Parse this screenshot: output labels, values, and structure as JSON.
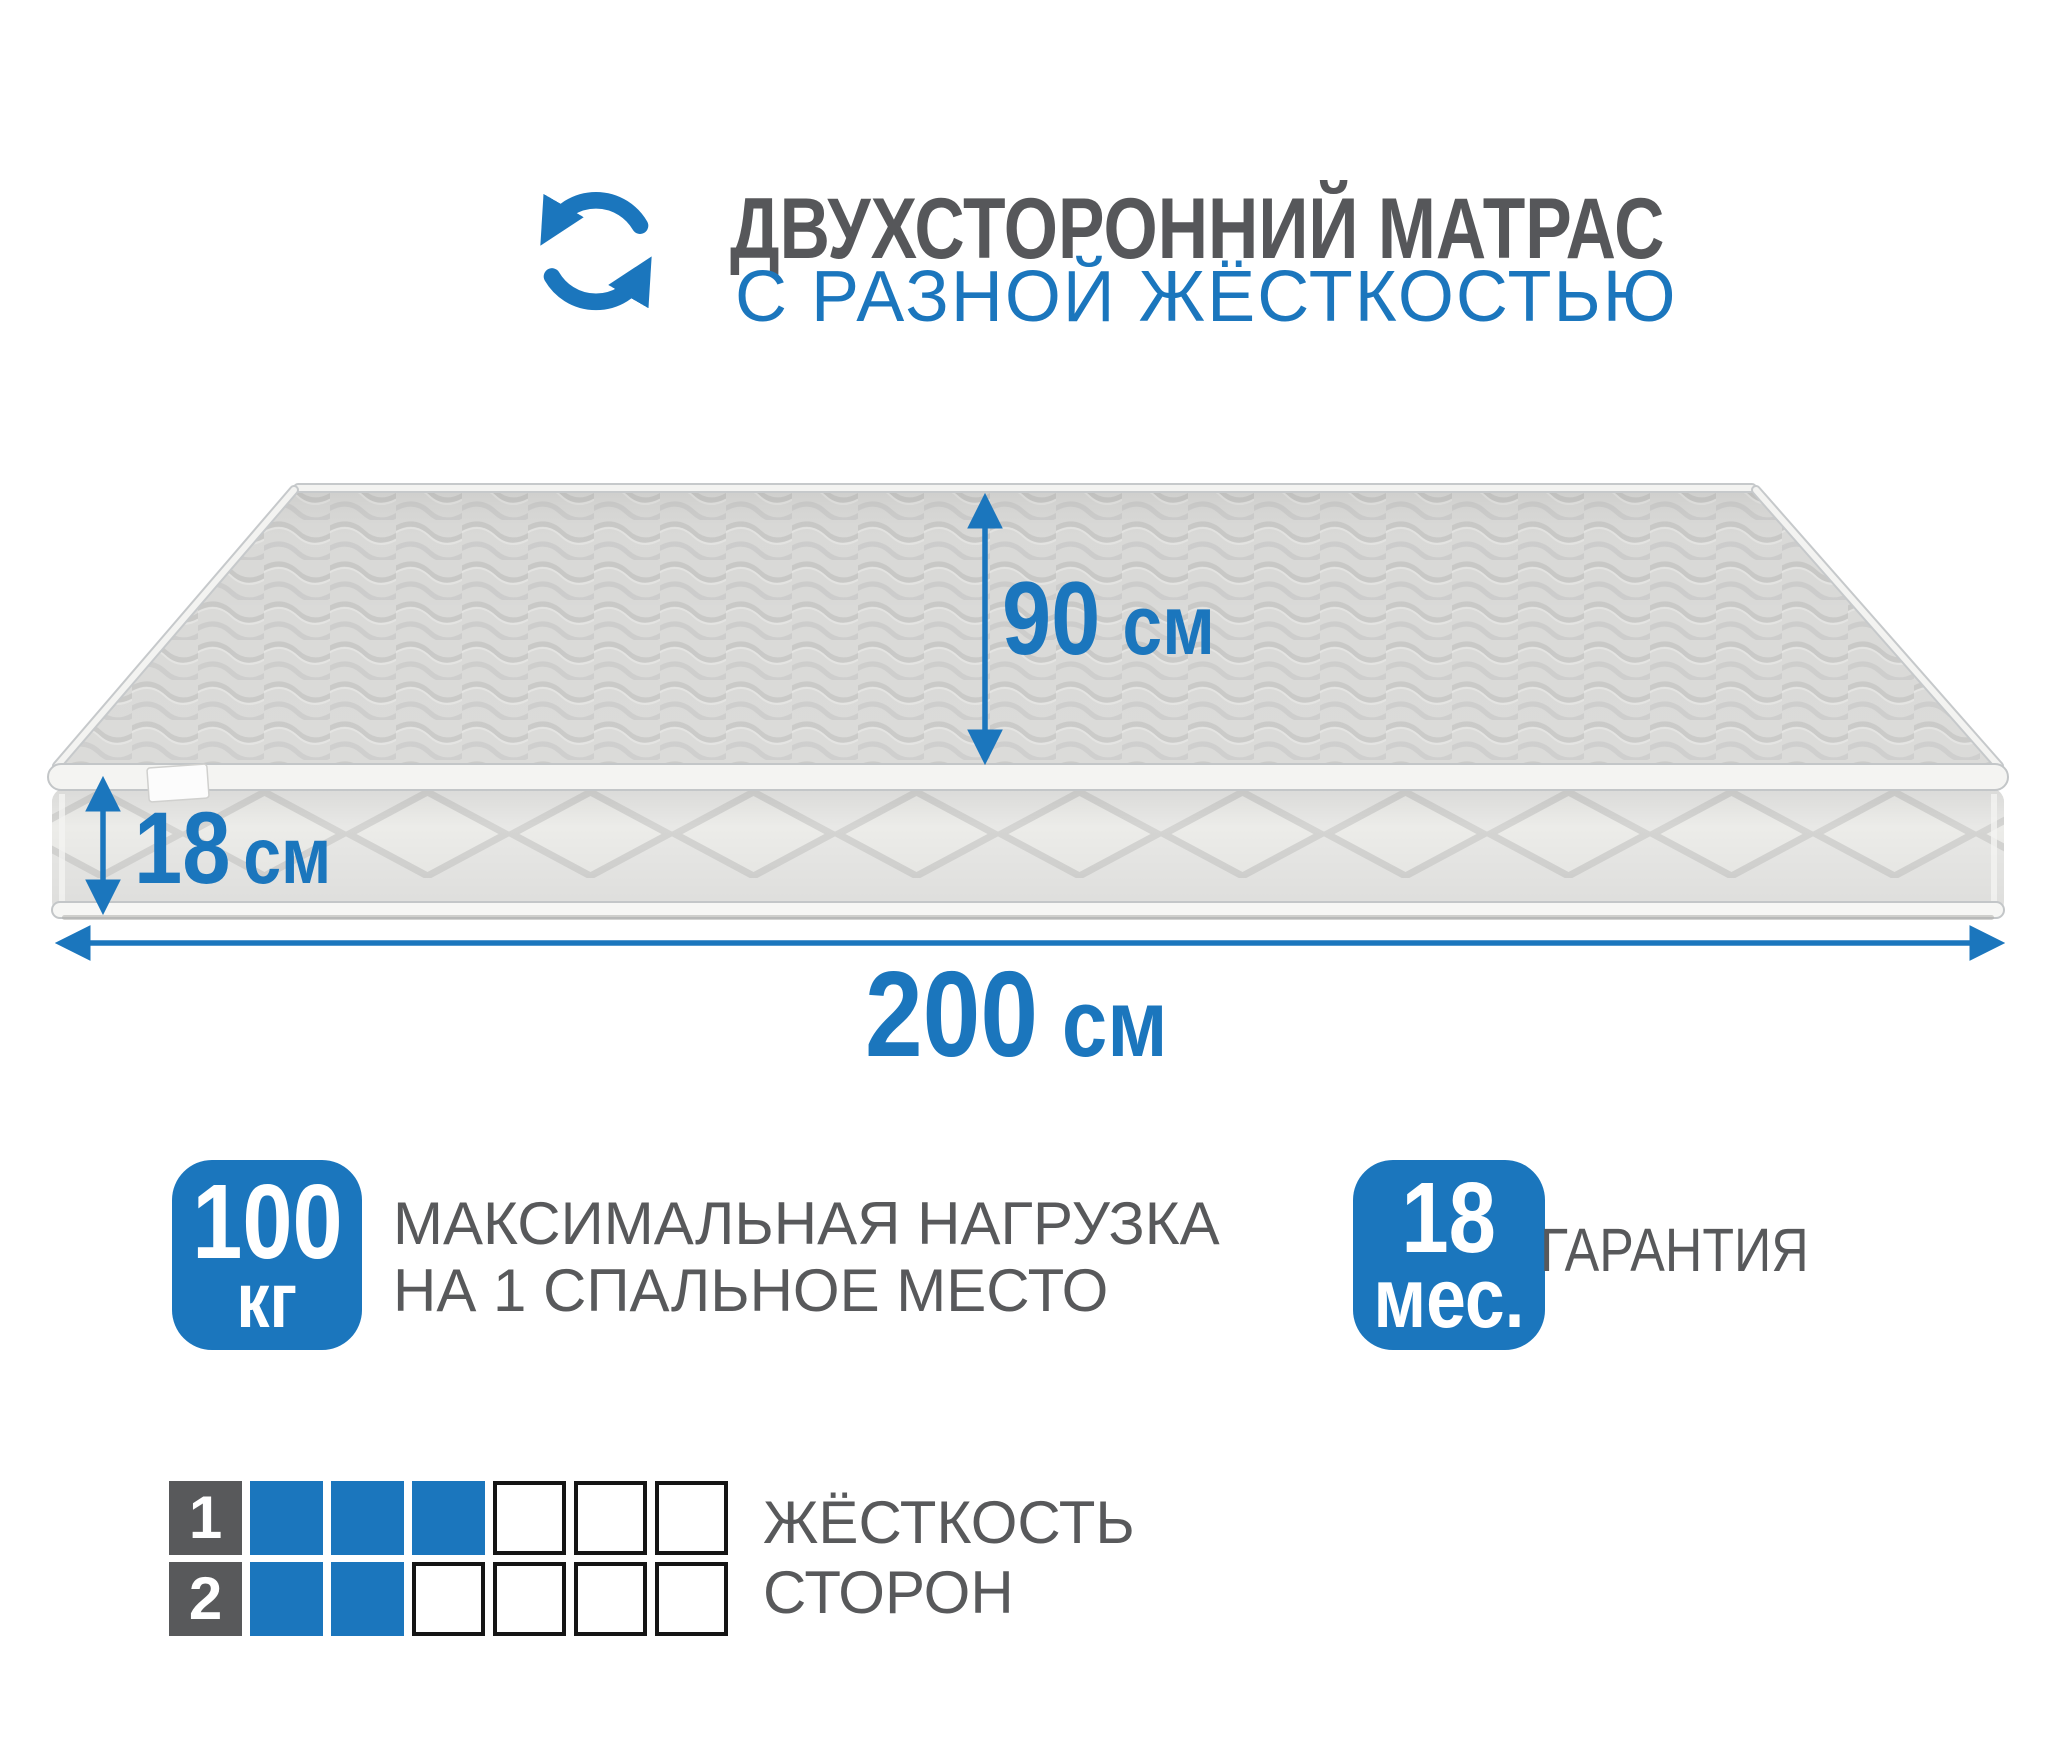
{
  "colors": {
    "accent": "#1b76bd",
    "text_gray": "#58595b",
    "mattress_top": "#d9d9d7",
    "mattress_side": "#e8e8e6"
  },
  "header": {
    "title": "ДВУХСТОРОННИЙ МАТРАС",
    "subtitle": "С РАЗНОЙ ЖЁСТКОСТЬЮ",
    "icon": "rotate-arrows-icon"
  },
  "mattress": {
    "width": {
      "value": "90",
      "unit": "см"
    },
    "height": {
      "value": "18",
      "unit": "см"
    },
    "length": {
      "value": "200",
      "unit": "см"
    }
  },
  "features": {
    "max_load": {
      "value": "100",
      "unit": "кг",
      "label": [
        "МАКСИМАЛЬНАЯ НАГРУЗКА",
        "НА 1 СПАЛЬНОЕ МЕСТО"
      ]
    },
    "warranty": {
      "value": "18",
      "unit": "мес.",
      "label": "ГАРАНТИЯ"
    }
  },
  "firmness": {
    "label": [
      "ЖЁСТКОСТЬ",
      "СТОРОН"
    ],
    "scale_total": 6,
    "rows": [
      {
        "side": "1",
        "filled": 3
      },
      {
        "side": "2",
        "filled": 2
      }
    ]
  }
}
